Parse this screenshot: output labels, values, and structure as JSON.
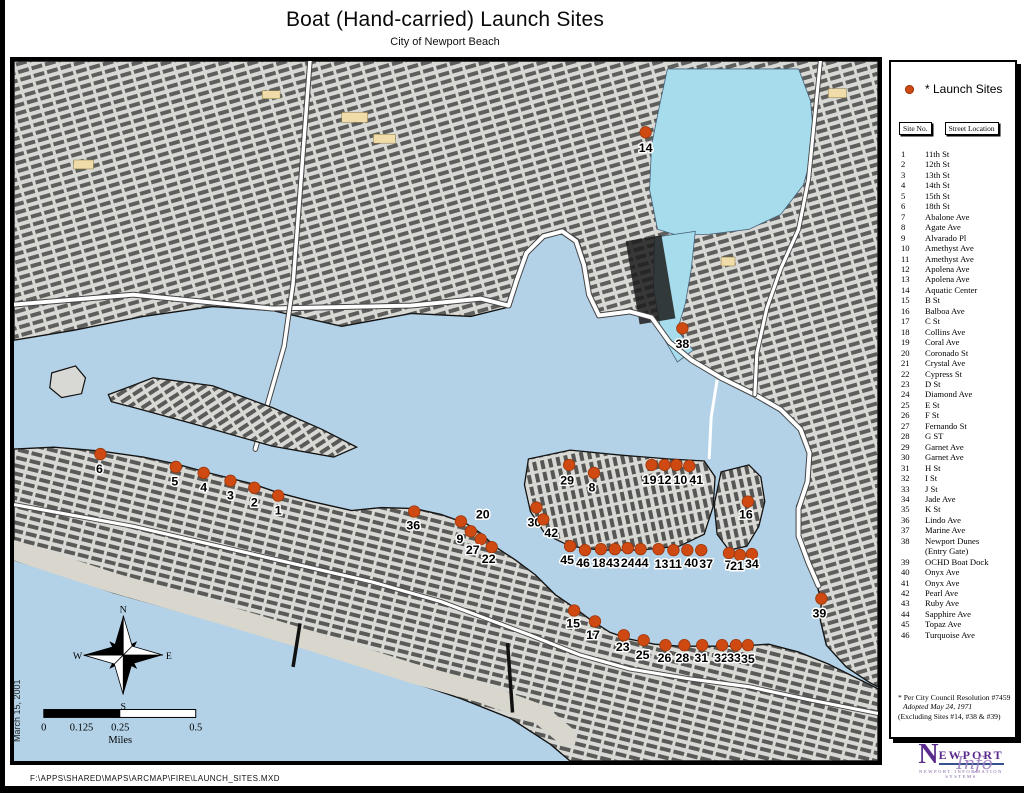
{
  "page": {
    "title": "Boat (Hand-carried) Launch Sites",
    "subtitle": "City of Newport Beach",
    "date_note": "March 15, 2001",
    "file_path": "F:\\APPS\\SHARED\\MAPS\\ARCMAP\\FIRE\\LAUNCH_SITES.MXD"
  },
  "colors": {
    "launch_dot": "#cf4a12",
    "launch_dot_edge": "#9a3509",
    "water": "#b3d2e8",
    "upper_bay": "#a6dcec",
    "land": "#d8d8d4",
    "logo_purple": "#5a2b8c"
  },
  "legend": {
    "label": "* Launch Sites"
  },
  "table": {
    "col_site": "Site No.",
    "col_street": "Street Location",
    "sites": [
      {
        "no": "1",
        "street": "11th St"
      },
      {
        "no": "2",
        "street": "12th St"
      },
      {
        "no": "3",
        "street": "13th St"
      },
      {
        "no": "4",
        "street": "14th St"
      },
      {
        "no": "5",
        "street": "15th St"
      },
      {
        "no": "6",
        "street": "18th St"
      },
      {
        "no": "7",
        "street": "Abalone Ave"
      },
      {
        "no": "8",
        "street": "Agate Ave"
      },
      {
        "no": "9",
        "street": "Alvarado Pl"
      },
      {
        "no": "10",
        "street": "Amethyst Ave"
      },
      {
        "no": "11",
        "street": "Amethyst Ave"
      },
      {
        "no": "12",
        "street": "Apolena Ave"
      },
      {
        "no": "13",
        "street": "Apolena Ave"
      },
      {
        "no": "14",
        "street": "Aquatic Center"
      },
      {
        "no": "15",
        "street": "B St"
      },
      {
        "no": "16",
        "street": "Balboa Ave"
      },
      {
        "no": "17",
        "street": "C St"
      },
      {
        "no": "18",
        "street": "Collins Ave"
      },
      {
        "no": "19",
        "street": "Coral Ave"
      },
      {
        "no": "20",
        "street": "Coronado St"
      },
      {
        "no": "21",
        "street": "Crystal Ave"
      },
      {
        "no": "22",
        "street": "Cypress St"
      },
      {
        "no": "23",
        "street": "D St"
      },
      {
        "no": "24",
        "street": "Diamond Ave"
      },
      {
        "no": "25",
        "street": "E St"
      },
      {
        "no": "26",
        "street": "F St"
      },
      {
        "no": "27",
        "street": "Fernando St"
      },
      {
        "no": "28",
        "street": "G ST"
      },
      {
        "no": "29",
        "street": "Garnet Ave"
      },
      {
        "no": "30",
        "street": "Garnet Ave"
      },
      {
        "no": "31",
        "street": "H St"
      },
      {
        "no": "32",
        "street": "I St"
      },
      {
        "no": "33",
        "street": "J St"
      },
      {
        "no": "34",
        "street": "Jade Ave"
      },
      {
        "no": "35",
        "street": "K St"
      },
      {
        "no": "36",
        "street": "Lindo Ave"
      },
      {
        "no": "37",
        "street": "Marine Ave"
      },
      {
        "no": "38",
        "street": "Newport Dunes\n(Entry Gate)"
      },
      {
        "no": "39",
        "street": "OCHD Boat Dock"
      },
      {
        "no": "40",
        "street": "Onyx Ave"
      },
      {
        "no": "41",
        "street": "Onyx Ave"
      },
      {
        "no": "42",
        "street": "Pearl Ave"
      },
      {
        "no": "43",
        "street": "Ruby Ave"
      },
      {
        "no": "44",
        "street": "Sapphire Ave"
      },
      {
        "no": "45",
        "street": "Topaz Ave"
      },
      {
        "no": "46",
        "street": "Turquoise Ave"
      }
    ]
  },
  "footnote": {
    "line1": "* Per City Council Resolution #7459",
    "line2": "Adopted May 24, 1971",
    "line3": "(Excluding Sites #14, #38 & #39)"
  },
  "logo": {
    "word1": "N",
    "word2": "EWPORT",
    "script": "Info",
    "subtext": "NEWPORT INFORMATION SYSTEMS"
  },
  "map": {
    "compass": {
      "n": "N",
      "e": "E",
      "s": "S",
      "w": "W"
    },
    "scale": {
      "t0": "0",
      "t1": "0.125",
      "t2": "0.25",
      "t3": "0.5",
      "units": "Miles"
    },
    "markers": [
      {
        "no": "1",
        "dot": [
          266,
          439
        ],
        "label": [
          266,
          458
        ]
      },
      {
        "no": "2",
        "dot": [
          242,
          431
        ],
        "label": [
          242,
          450
        ]
      },
      {
        "no": "3",
        "dot": [
          218,
          424
        ],
        "label": [
          218,
          443
        ]
      },
      {
        "no": "4",
        "dot": [
          191,
          416
        ],
        "label": [
          191,
          435
        ]
      },
      {
        "no": "5",
        "dot": [
          163,
          410
        ],
        "label": [
          162,
          429
        ]
      },
      {
        "no": "6",
        "dot": [
          87,
          397
        ],
        "label": [
          86,
          416
        ]
      },
      {
        "no": "7",
        "dot": [
          720,
          497
        ],
        "label": [
          719,
          513
        ]
      },
      {
        "no": "8",
        "dot": [
          584,
          416
        ],
        "label": [
          582,
          435
        ]
      },
      {
        "no": "9",
        "dot": [
          460,
          475
        ],
        "label": [
          449,
          487
        ]
      },
      {
        "no": "10",
        "dot": [
          667,
          408
        ],
        "label": [
          671,
          427
        ]
      },
      {
        "no": "11",
        "dot": [
          664,
          494
        ],
        "label": [
          666,
          512
        ]
      },
      {
        "no": "12",
        "dot": [
          655,
          408
        ],
        "label": [
          655,
          427
        ]
      },
      {
        "no": "13",
        "dot": [
          649,
          493
        ],
        "label": [
          652,
          512
        ]
      },
      {
        "no": "14",
        "dot": [
          636,
          72
        ],
        "label": [
          636,
          92
        ]
      },
      {
        "no": "15",
        "dot": [
          564,
          555
        ],
        "label": [
          563,
          572
        ]
      },
      {
        "no": "16",
        "dot": [
          739,
          445
        ],
        "label": [
          737,
          462
        ]
      },
      {
        "no": "17",
        "dot": [
          585,
          566
        ],
        "label": [
          583,
          584
        ]
      },
      {
        "no": "18",
        "dot": [
          591,
          493
        ],
        "label": [
          589,
          511
        ]
      },
      {
        "no": "19",
        "dot": [
          642,
          408
        ],
        "label": [
          640,
          427
        ]
      },
      {
        "no": "20",
        "dot": [
          450,
          465
        ],
        "label": [
          472,
          462
        ]
      },
      {
        "no": "21",
        "dot": [
          731,
          499
        ],
        "label": [
          728,
          514
        ]
      },
      {
        "no": "22",
        "dot": [
          481,
          491
        ],
        "label": [
          478,
          507
        ]
      },
      {
        "no": "23",
        "dot": [
          614,
          580
        ],
        "label": [
          613,
          596
        ]
      },
      {
        "no": "24",
        "dot": [
          618,
          492
        ],
        "label": [
          618,
          511
        ]
      },
      {
        "no": "25",
        "dot": [
          634,
          585
        ],
        "label": [
          633,
          604
        ]
      },
      {
        "no": "26",
        "dot": [
          656,
          590
        ],
        "label": [
          655,
          607
        ]
      },
      {
        "no": "27",
        "dot": [
          470,
          483
        ],
        "label": [
          462,
          498
        ]
      },
      {
        "no": "28",
        "dot": [
          675,
          590
        ],
        "label": [
          673,
          607
        ]
      },
      {
        "no": "29",
        "dot": [
          559,
          408
        ],
        "label": [
          557,
          428
        ]
      },
      {
        "no": "30",
        "dot": [
          526,
          451
        ],
        "label": [
          524,
          470
        ]
      },
      {
        "no": "31",
        "dot": [
          693,
          590
        ],
        "label": [
          692,
          607
        ]
      },
      {
        "no": "32",
        "dot": [
          713,
          590
        ],
        "label": [
          712,
          607
        ]
      },
      {
        "no": "33",
        "dot": [
          727,
          590
        ],
        "label": [
          725,
          607
        ]
      },
      {
        "no": "34",
        "dot": [
          743,
          498
        ],
        "label": [
          743,
          512
        ]
      },
      {
        "no": "35",
        "dot": [
          739,
          590
        ],
        "label": [
          739,
          608
        ]
      },
      {
        "no": "36",
        "dot": [
          403,
          455
        ],
        "label": [
          402,
          473
        ]
      },
      {
        "no": "37",
        "dot": [
          692,
          494
        ],
        "label": [
          697,
          512
        ]
      },
      {
        "no": "38",
        "dot": [
          673,
          270
        ],
        "label": [
          673,
          290
        ]
      },
      {
        "no": "39",
        "dot": [
          813,
          543
        ],
        "label": [
          811,
          562
        ]
      },
      {
        "no": "40",
        "dot": [
          678,
          494
        ],
        "label": [
          682,
          511
        ]
      },
      {
        "no": "41",
        "dot": [
          680,
          409
        ],
        "label": [
          687,
          427
        ]
      },
      {
        "no": "42",
        "dot": [
          533,
          463
        ],
        "label": [
          541,
          481
        ]
      },
      {
        "no": "43",
        "dot": [
          605,
          493
        ],
        "label": [
          603,
          511
        ]
      },
      {
        "no": "44",
        "dot": [
          631,
          493
        ],
        "label": [
          632,
          511
        ]
      },
      {
        "no": "45",
        "dot": [
          560,
          490
        ],
        "label": [
          557,
          508
        ]
      },
      {
        "no": "46",
        "dot": [
          575,
          494
        ],
        "label": [
          573,
          511
        ]
      }
    ]
  }
}
